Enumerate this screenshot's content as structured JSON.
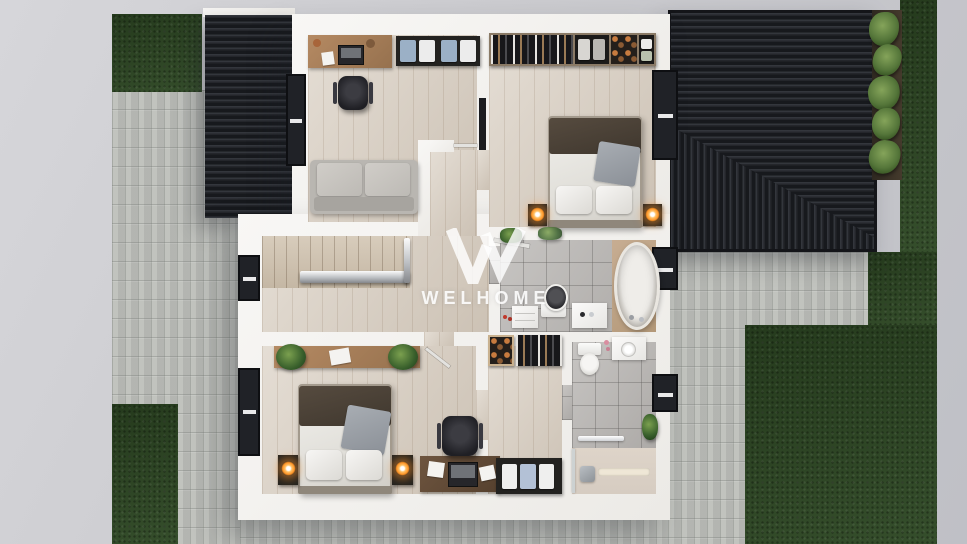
{
  "watermark": {
    "brand": "WELHOME"
  },
  "palette": {
    "background": "#cacace",
    "paving": "#bdbfba",
    "grass": "#2d4723",
    "roof": "#202227",
    "roof_ribs": "#33363c",
    "wall": "#f5f4f1",
    "wood_floor": "#d9cfc2",
    "tile_floor": "#b7b4b1",
    "shower_floor": "#dcd2c7",
    "lamp_glow": "#ff9426",
    "plant_green": "#4e7a34",
    "watermark_white": "#ffffff"
  },
  "floorplan": {
    "view": "top-down-3d-render-second-floor",
    "rooms": [
      {
        "id": "office",
        "items": [
          "desk",
          "office-chair",
          "bedding-shelf",
          "sofa",
          "balcony-glass-door"
        ]
      },
      {
        "id": "master-bedroom",
        "items": [
          "open-wardrobe",
          "double-bed",
          "pillow",
          "pillow",
          "nightstand",
          "table-lamp",
          "nightstand",
          "table-lamp",
          "wall-tv",
          "window"
        ]
      },
      {
        "id": "bathroom-1",
        "items": [
          "freestanding-bathtub",
          "toilet",
          "vanity-sink",
          "dresser",
          "plant",
          "window"
        ]
      },
      {
        "id": "landing",
        "items": [
          "staircase",
          "glass-railing",
          "window"
        ]
      },
      {
        "id": "bedroom-2",
        "items": [
          "console-with-plants",
          "double-bed",
          "pillow",
          "pillow",
          "nightstand",
          "table-lamp",
          "nightstand",
          "table-lamp",
          "desk",
          "office-chair",
          "window"
        ]
      },
      {
        "id": "walk-in-closet",
        "items": [
          "shoe-shelf",
          "hanging-rail",
          "linen-cabinet"
        ]
      },
      {
        "id": "bathroom-2",
        "items": [
          "toilet",
          "vanity-sink",
          "towel-rail",
          "walk-in-shower",
          "linear-drain",
          "plant",
          "window"
        ]
      }
    ],
    "exterior": {
      "features": [
        "flat-dark-roof-left",
        "dark-hip-roof-right",
        "fern-planting-bed",
        "lawn-patches",
        "block-paving"
      ]
    }
  }
}
